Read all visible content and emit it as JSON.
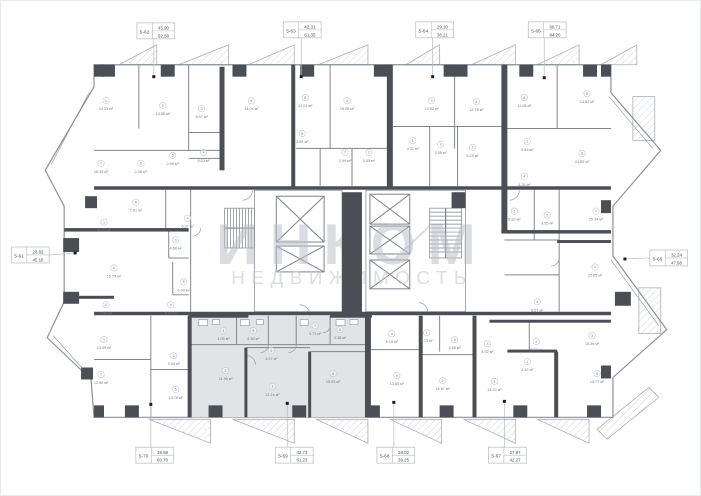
{
  "plan": {
    "wall_color": "#4a4f56",
    "line_color": "#8b9199",
    "highlight_fill": "#e2e3e5",
    "callout_border": "#b5bbc2",
    "area_unit": "м²"
  },
  "watermark": {
    "title": "ИНКОМ",
    "subtitle": "НЕДВИЖИМОСТЬ"
  },
  "units": [
    {
      "id": "5-62",
      "area1": "45.90",
      "area2": "62.58",
      "box": [
        136,
        22
      ],
      "dot": [
        153,
        76
      ],
      "side": "top",
      "highlighted": false
    },
    {
      "id": "5-63",
      "area1": "42.31",
      "area2": "61.35",
      "box": [
        283,
        21
      ],
      "dot": [
        301,
        76
      ],
      "side": "top",
      "highlighted": false
    },
    {
      "id": "5-64",
      "area1": "29.10",
      "area2": "38.21",
      "box": [
        416,
        21
      ],
      "dot": [
        433,
        76
      ],
      "side": "top",
      "highlighted": false
    },
    {
      "id": "5-65",
      "area1": "60.71",
      "area2": "84.20",
      "box": [
        529,
        21
      ],
      "dot": [
        545,
        77
      ],
      "side": "top",
      "highlighted": false
    },
    {
      "id": "5-66",
      "area1": "32.24",
      "area2": "47.98",
      "box": [
        651,
        250
      ],
      "dot": [
        626,
        259
      ],
      "side": "right",
      "highlighted": false
    },
    {
      "id": "5-61",
      "area1": "28.82",
      "area2": "45.18",
      "box": [
        10,
        247
      ],
      "dot": [
        74,
        253
      ],
      "side": "left",
      "highlighted": false
    },
    {
      "id": "5-70",
      "area1": "38.58",
      "area2": "60.78",
      "box": [
        135,
        448
      ],
      "dot": [
        150,
        405
      ],
      "side": "bottom",
      "highlighted": false
    },
    {
      "id": "5-69",
      "area1": "42.73",
      "area2": "61.23",
      "box": [
        275,
        448
      ],
      "dot": [
        287,
        404
      ],
      "side": "bottom",
      "highlighted": true
    },
    {
      "id": "5-68",
      "area1": "28.02",
      "area2": "39.25",
      "box": [
        377,
        448
      ],
      "dot": [
        394,
        403
      ],
      "side": "bottom",
      "highlighted": false
    },
    {
      "id": "5-67",
      "area1": "27.97",
      "area2": "42.27",
      "box": [
        489,
        448
      ],
      "dot": [
        505,
        402
      ],
      "side": "bottom",
      "highlighted": false
    }
  ],
  "rooms": [
    {
      "n": "1",
      "a": "14.53 м²",
      "x": 105,
      "y": 100
    },
    {
      "n": "2",
      "a": "14.88 м²",
      "x": 162,
      "y": 105
    },
    {
      "n": "3",
      "a": "5.97 м²",
      "x": 201,
      "y": 108
    },
    {
      "n": "7",
      "a": "16.33 м²",
      "x": 100,
      "y": 163
    },
    {
      "n": "6",
      "a": "2.08 м²",
      "x": 140,
      "y": 163
    },
    {
      "n": "5",
      "a": "2.06 м²",
      "x": 172,
      "y": 155
    },
    {
      "n": "4",
      "a": "5.03 м²",
      "x": 203,
      "y": 152
    },
    {
      "n": "8",
      "a": "14.04 м²",
      "x": 251,
      "y": 100
    },
    {
      "n": "5",
      "a": "12.01 м²",
      "x": 305,
      "y": 97
    },
    {
      "n": "4",
      "a": "15.06 м²",
      "x": 347,
      "y": 100
    },
    {
      "n": "6",
      "a": "3.96 м²",
      "x": 302,
      "y": 133
    },
    {
      "n": "7",
      "a": "2.99 м²",
      "x": 345,
      "y": 152
    },
    {
      "n": "2",
      "a": "3.53 м²",
      "x": 369,
      "y": 152
    },
    {
      "n": "1",
      "a": "4.31 м²",
      "x": 413,
      "y": 140
    },
    {
      "n": "3",
      "a": "3.56 м²",
      "x": 441,
      "y": 144
    },
    {
      "n": "3",
      "a": "12.52 м²",
      "x": 432,
      "y": 100
    },
    {
      "n": "4",
      "a": "12.78 м²",
      "x": 477,
      "y": 101
    },
    {
      "n": "2",
      "a": "5.24 м²",
      "x": 473,
      "y": 147
    },
    {
      "n": "6",
      "a": "11.08 м²",
      "x": 525,
      "y": 97
    },
    {
      "n": "5",
      "a": "13.82 м²",
      "x": 588,
      "y": 93
    },
    {
      "n": "8",
      "a": "24.85 м²",
      "x": 583,
      "y": 153
    },
    {
      "n": "1",
      "a": "4.63 м²",
      "x": 528,
      "y": 141
    },
    {
      "n": "4",
      "a": "4.25 м²",
      "x": 525,
      "y": 176
    },
    {
      "n": "2",
      "a": "5.83 м²",
      "x": 515,
      "y": 211
    },
    {
      "n": "3",
      "a": "3.55 м²",
      "x": 548,
      "y": 215
    },
    {
      "n": "7",
      "a": "15.34 м²",
      "x": 597,
      "y": 211
    },
    {
      "n": "1",
      "a": "15.85 м²",
      "x": 596,
      "y": 267
    },
    {
      "n": "4",
      "a": "5.57 м²",
      "x": 538,
      "y": 302
    },
    {
      "n": "2",
      "a": "5.27 м²",
      "x": 537,
      "y": 342
    },
    {
      "n": "3",
      "a": "15.39 м²",
      "x": 593,
      "y": 336
    },
    {
      "n": "1",
      "a": "4.42 м²",
      "x": 528,
      "y": 362
    },
    {
      "n": "5",
      "a": "13.77 м²",
      "x": 598,
      "y": 374
    },
    {
      "n": "4",
      "a": "14.20 м²",
      "x": 495,
      "y": 382
    },
    {
      "n": "3",
      "a": "4.92 м²",
      "x": 488,
      "y": 344
    },
    {
      "n": "4",
      "a": "5.19 м²",
      "x": 392,
      "y": 334
    },
    {
      "n": "1",
      "a": "2.73 м²",
      "x": 427,
      "y": 333
    },
    {
      "n": "3",
      "a": "3.68 м²",
      "x": 455,
      "y": 340
    },
    {
      "n": "5",
      "a": "13.65 м²",
      "x": 397,
      "y": 376
    },
    {
      "n": "2",
      "a": "14.67 м²",
      "x": 443,
      "y": 381
    },
    {
      "n": "4",
      "a": "4.05 м²",
      "x": 223,
      "y": 331
    },
    {
      "n": "5",
      "a": "4.38 м²",
      "x": 253,
      "y": 331
    },
    {
      "n": "7",
      "a": "3.73 м²",
      "x": 315,
      "y": 326
    },
    {
      "n": "3",
      "a": "3.38 м²",
      "x": 340,
      "y": 330
    },
    {
      "n": "6",
      "a": "3.97 м²",
      "x": 271,
      "y": 351
    },
    {
      "n": "2",
      "a": "14.98 м²",
      "x": 225,
      "y": 371
    },
    {
      "n": "1",
      "a": "12.14 м²",
      "x": 272,
      "y": 387
    },
    {
      "n": "8",
      "a": "15.93 м²",
      "x": 333,
      "y": 374
    },
    {
      "n": "1",
      "a": "13.09 м²",
      "x": 103,
      "y": 340
    },
    {
      "n": "7",
      "a": "12.59 м²",
      "x": 100,
      "y": 375
    },
    {
      "n": "3",
      "a": "3.94 м²",
      "x": 173,
      "y": 356
    },
    {
      "n": "5",
      "a": "13.76 м²",
      "x": 175,
      "y": 390
    },
    {
      "n": "2",
      "a": "7.02 м²",
      "x": 105,
      "y": 305
    },
    {
      "n": "4",
      "a": "5.02 м²",
      "x": 170,
      "y": 305
    },
    {
      "n": "1",
      "a": "11.01 м²",
      "x": 103,
      "y": 222
    },
    {
      "n": "2",
      "a": "15.75 м²",
      "x": 113,
      "y": 268
    },
    {
      "n": "4",
      "a": "6.07 м²",
      "x": 187,
      "y": 218
    },
    {
      "n": "3",
      "a": "4.68 м²",
      "x": 175,
      "y": 240
    },
    {
      "n": "5",
      "a": "5.03 м²",
      "x": 183,
      "y": 282
    },
    {
      "n": "6",
      "a": "7.61 м²",
      "x": 135,
      "y": 202
    }
  ]
}
